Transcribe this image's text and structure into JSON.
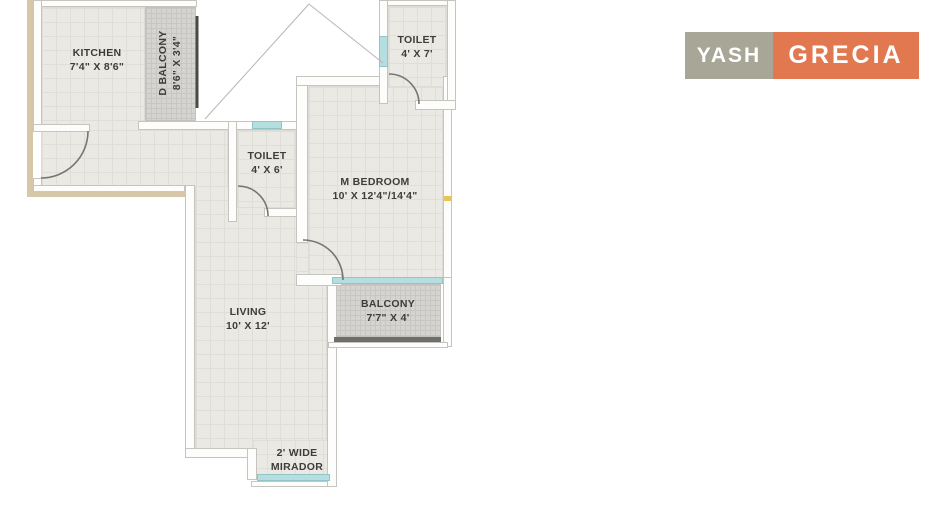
{
  "logo": {
    "brand": "YASH",
    "product": "GRECIA"
  },
  "rooms": {
    "kitchen": {
      "line1": "KITCHEN",
      "line2": "7'4\" X 8'6\""
    },
    "d_balcony": {
      "line1": "D BALCONY",
      "line2": "8'6\" X 3'4\""
    },
    "toilet_top": {
      "line1": "TOILET",
      "line2": "4' X 7'"
    },
    "toilet_mid": {
      "line1": "TOILET",
      "line2": "4' X 6'"
    },
    "m_bedroom": {
      "line1": "M BEDROOM",
      "line2": "10' X 12'4\"/14'4\""
    },
    "living": {
      "line1": "LIVING",
      "line2": "10' X 12'"
    },
    "balcony": {
      "line1": "BALCONY",
      "line2": "7'7\" X 4'"
    },
    "mirador": {
      "line1": "2' WIDE",
      "line2": "MIRADOR"
    }
  },
  "colors": {
    "logo_brand_bg": "#a8a697",
    "logo_product_bg": "#e2784f",
    "window_glass": "#b5dee0",
    "outer_wall_accent": "#d5c7a7",
    "floor": "#ebe9e4",
    "balcony_floor": "#d5d4d0",
    "railing": "#4a4a48"
  }
}
